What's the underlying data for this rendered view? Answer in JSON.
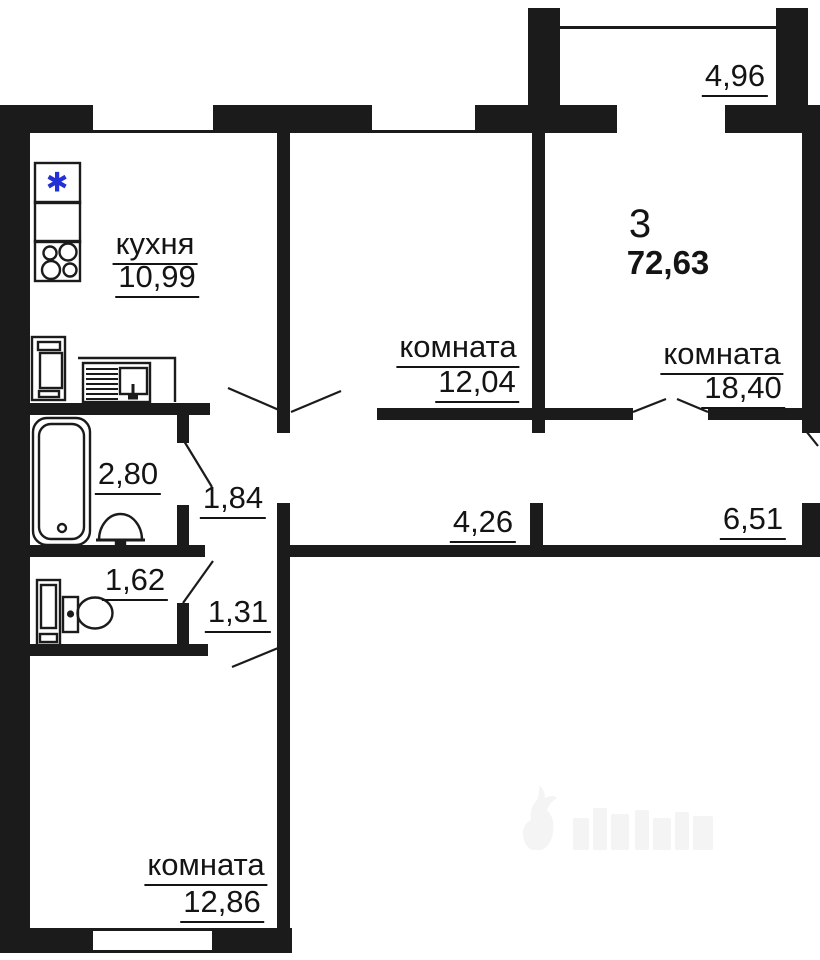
{
  "plan_title": "apartment floor plan",
  "summary": {
    "rooms_count": "3",
    "total_area": "72,63"
  },
  "rooms": {
    "kitchen_name": "кухня",
    "kitchen_area": "10,99",
    "room1_name": "комната",
    "room1_area": "12,04",
    "room2_name": "комната",
    "room2_area": "18,40",
    "room3_name": "комната",
    "room3_area": "12,86",
    "balcony_area": "4,96",
    "bathroom_area": "2,80",
    "hall1_area": "1,84",
    "wc_area": "1,62",
    "hall2_area": "1,31",
    "corridor1_area": "4,26",
    "corridor2_area": "6,51"
  },
  "icons": {
    "fridge_star": "✱"
  },
  "colors": {
    "wall": "#1b1b1b",
    "fridge_star_blue": "#2330d6",
    "watermark_gray": "#f4f4f4"
  }
}
